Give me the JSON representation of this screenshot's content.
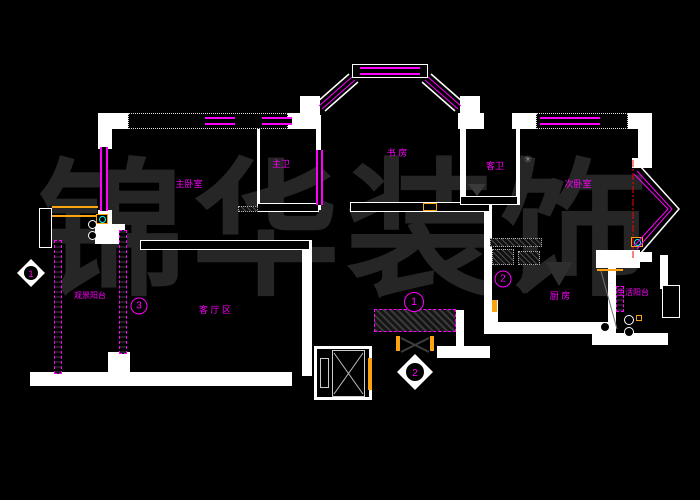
{
  "drawing": {
    "watermark": "锦华装饰",
    "type_note": "residential floor plan"
  },
  "colors": {
    "background": "#000000",
    "wall": "#ffffff",
    "annotation": "#ff00ff",
    "accent": "#fca311",
    "centerline": "#ff0000",
    "watermark": "#262626"
  },
  "rooms": [
    {
      "id": "master-bedroom",
      "label": "主卧室"
    },
    {
      "id": "master-bath",
      "label": "主卫"
    },
    {
      "id": "study",
      "label": "书 房"
    },
    {
      "id": "guest-bath",
      "label": "客卫"
    },
    {
      "id": "second-bedroom",
      "label": "次卧室"
    },
    {
      "id": "view-balcony",
      "label": "观景阳台"
    },
    {
      "id": "living-area",
      "label": "客 厅 区"
    },
    {
      "id": "kitchen",
      "label": "厨 房"
    },
    {
      "id": "service-balcony",
      "label": "生活阳台"
    }
  ],
  "markers": {
    "m1": "1",
    "m2": "2",
    "m3": "3"
  },
  "diamonds": {
    "d1": "1",
    "d2": "2"
  },
  "icons": {
    "fan_glyph": "✳"
  }
}
